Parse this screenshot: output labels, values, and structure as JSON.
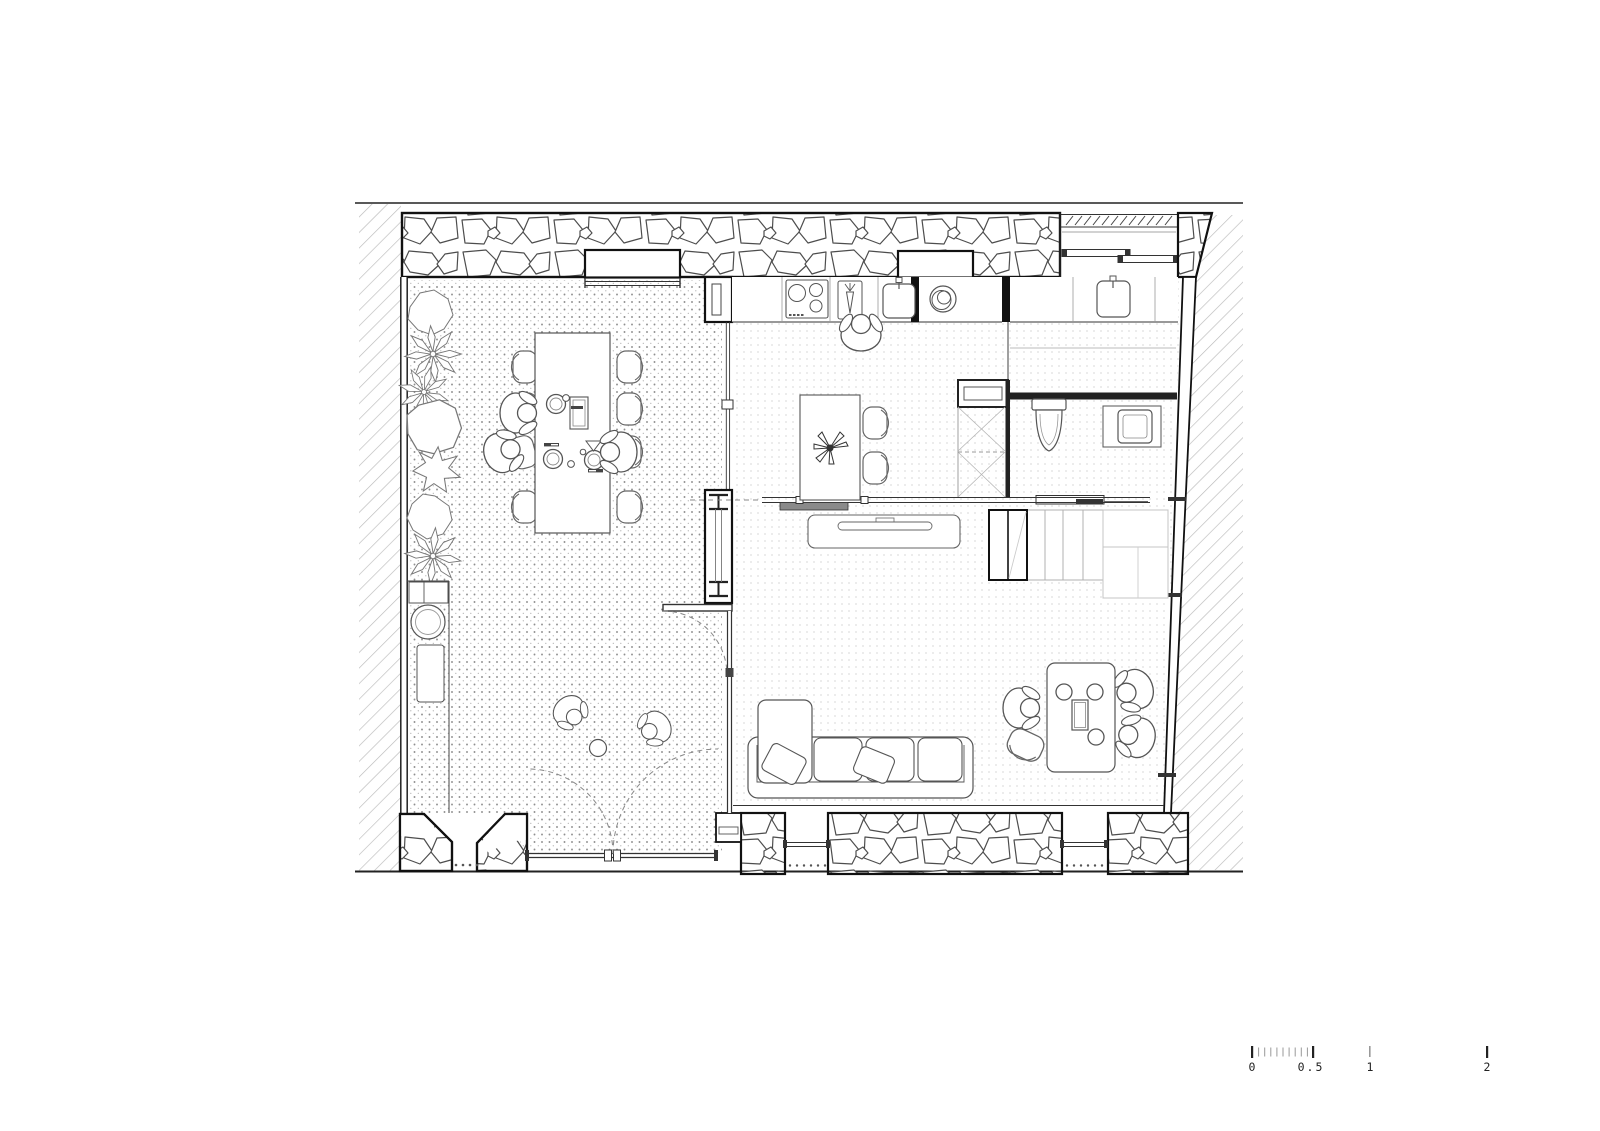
{
  "page": {
    "background": "#ffffff"
  },
  "drawing": {
    "kind": "ground-floor-plan",
    "line_color": "#222222",
    "stone_line_color": "#4d4d4d",
    "patio_stipple_color": "#8f8f8f",
    "interior_stipple_color": "#c2c2c2",
    "hatch_color": "#bababa",
    "sliding_panel_gray": "#8a8a8a"
  },
  "scale_bar": {
    "labels": [
      "0",
      "0.5",
      "1",
      "2"
    ]
  },
  "fixtures": [
    "stone-wall-icon",
    "hatch-context-icon",
    "cooktop-icon",
    "cutting-board-icon",
    "kitchen-sink-icon",
    "washing-machine-icon",
    "utility-sink-icon",
    "toilet-icon",
    "washbasin-icon",
    "shower-icon",
    "stairs-icon",
    "closet-icon",
    "sliding-door-icon",
    "hinged-door-icon",
    "steel-column-icon",
    "glazed-partition-icon",
    "dining-table-icon",
    "outdoor-table-icon",
    "work-table-icon",
    "chair-icon",
    "armchair-icon",
    "sofa-icon",
    "cushion-icon",
    "low-cabinet-icon",
    "plant-bush-icon",
    "plant-palm-icon",
    "person-icon",
    "ball-icon",
    "window-icon",
    "gate-icon"
  ]
}
